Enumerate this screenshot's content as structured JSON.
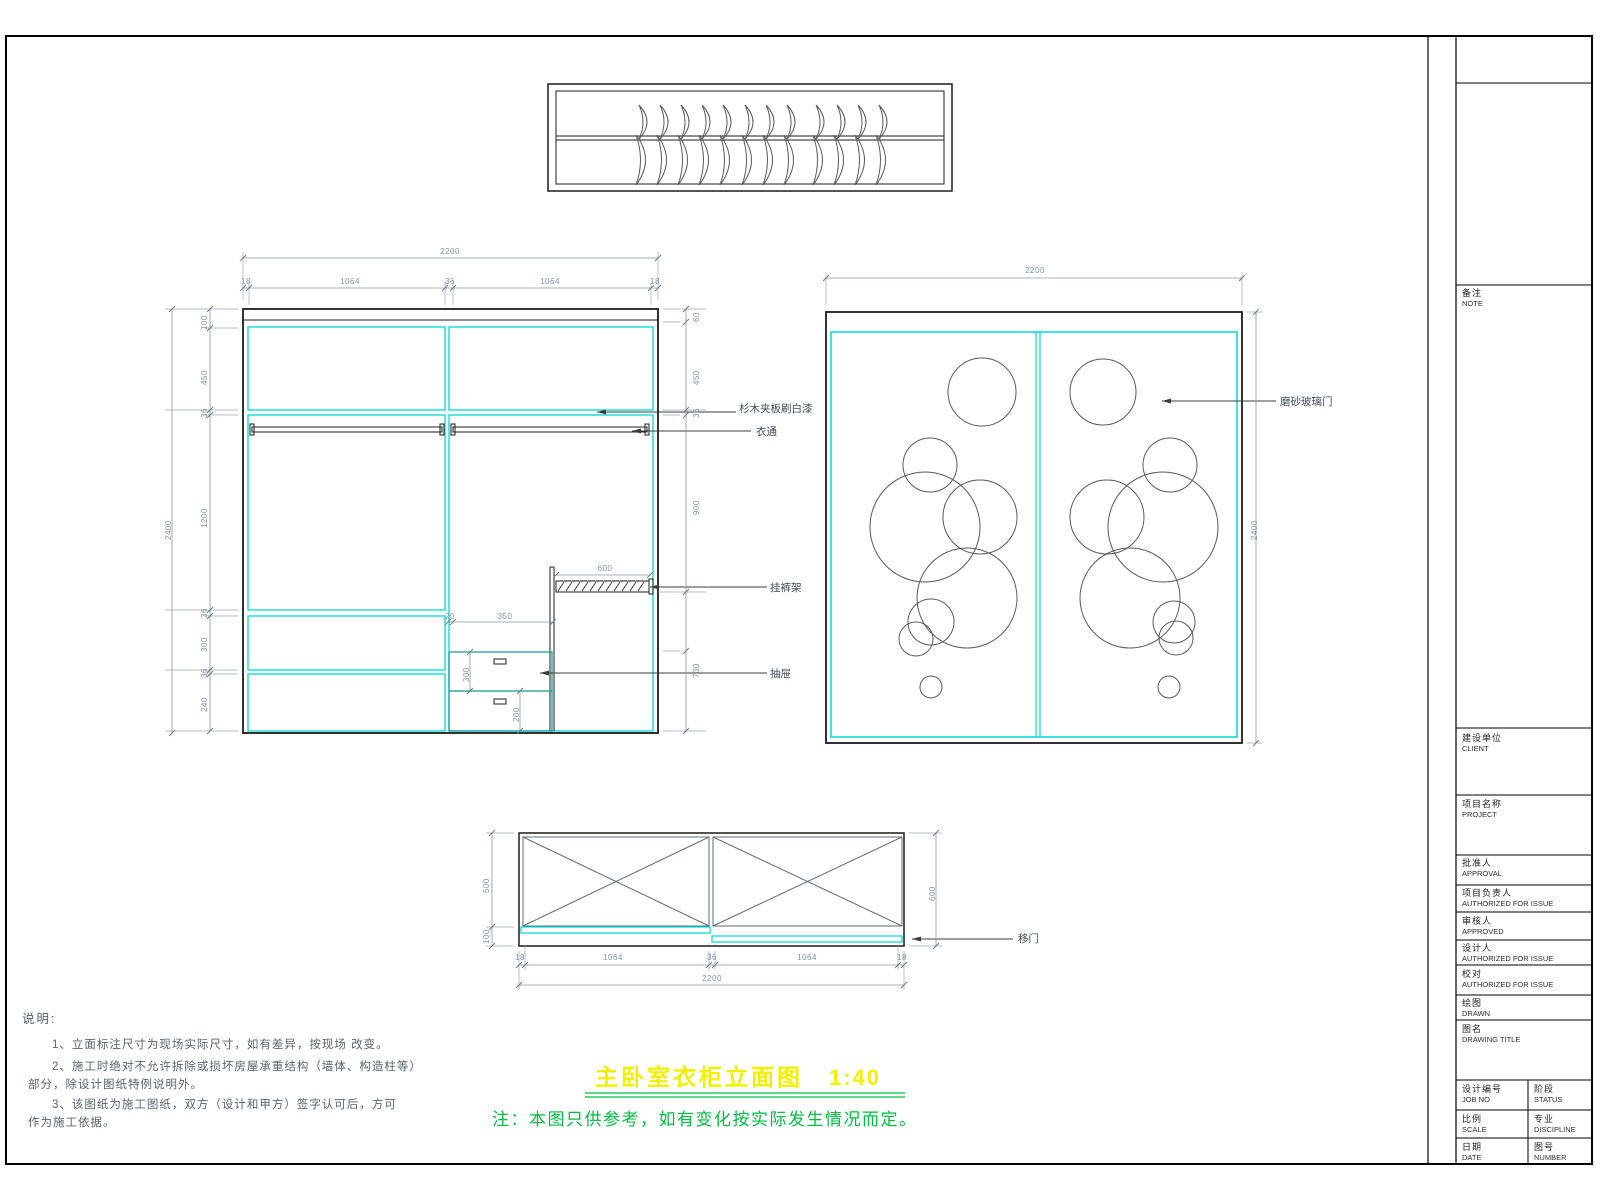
{
  "drawing_title": {
    "text": "主卧室衣柜立面图",
    "scale": "1:40",
    "note": "注：本图只供参考，如有变化按实际发生情况而定。"
  },
  "notes": {
    "heading": "说明:",
    "line1": "1、立面标注尺寸为现场实际尺寸，如有差异，按现场 改变。",
    "line2": "2、施工时绝对不允许拆除或损坏房屋承重结构（墙体、构造柱等）",
    "line2b": "部分，除设计图纸特例说明外。",
    "line3": "3、该图纸为施工图纸，双方（设计和甲方）签字认可后，方可",
    "line3b": "作为施工依据。"
  },
  "callouts": {
    "panel": "杉木夹板刷白漆",
    "rod": "衣通",
    "trouser_rack": "挂裤架",
    "drawer": "抽屉",
    "glass_door": "磨砂玻璃门",
    "sliding_door": "移门"
  },
  "dims": {
    "elev_total_w": "2200",
    "elev_top_segs": [
      "18",
      "1064",
      "36",
      "1064",
      "18"
    ],
    "elev_total_h": "2400",
    "elev_left_segs": [
      "100",
      "450",
      "36",
      "1200",
      "36",
      "300",
      "36",
      "240"
    ],
    "elev_right_segs": [
      "60",
      "450",
      "36",
      "900",
      "730"
    ],
    "elev_mid": {
      "rack_len": "600",
      "drawer_gap": "20",
      "drawer_w": "350",
      "drawer_h": "300",
      "drawer_h2": "200"
    },
    "door_total_w": "2200",
    "door_total_h": "2400",
    "plan_depth": "500",
    "plan_track": "100",
    "plan_total_d": "600",
    "plan_bottom_segs": [
      "18",
      "1064",
      "36",
      "1064",
      "18"
    ],
    "plan_total_w": "2200"
  },
  "titleblock": {
    "fields": [
      {
        "zh": "备注",
        "en": "NOTE"
      },
      {
        "zh": "建设单位",
        "en": "CLIENT"
      },
      {
        "zh": "项目名称",
        "en": "PROJECT"
      },
      {
        "zh": "批准人",
        "en": "APPROVAL"
      },
      {
        "zh": "项目负责人",
        "en": "AUTHORIZED FOR ISSUE"
      },
      {
        "zh": "审核人",
        "en": "APPROVED"
      },
      {
        "zh": "设计人",
        "en": "AUTHORIZED FOR ISSUE"
      },
      {
        "zh": "校对",
        "en": "AUTHORIZED FOR ISSUE"
      },
      {
        "zh": "绘图",
        "en": "DRAWN"
      },
      {
        "zh": "图名",
        "en": "DRAWING TITLE"
      }
    ],
    "grid": [
      {
        "zh": "设计编号",
        "en": "JOB NO"
      },
      {
        "zh": "阶段",
        "en": "STATUS"
      },
      {
        "zh": "比例",
        "en": "SCALE"
      },
      {
        "zh": "专业",
        "en": "DISCIPLINE"
      },
      {
        "zh": "日期",
        "en": "DATE"
      },
      {
        "zh": "图号",
        "en": "NUMBER"
      }
    ]
  },
  "colors": {
    "line": "#1c1c1c",
    "cyan": "#00d8d8",
    "dim_text": "#7d93ad",
    "green": "#00bf40",
    "yellow": "#f0f000"
  }
}
